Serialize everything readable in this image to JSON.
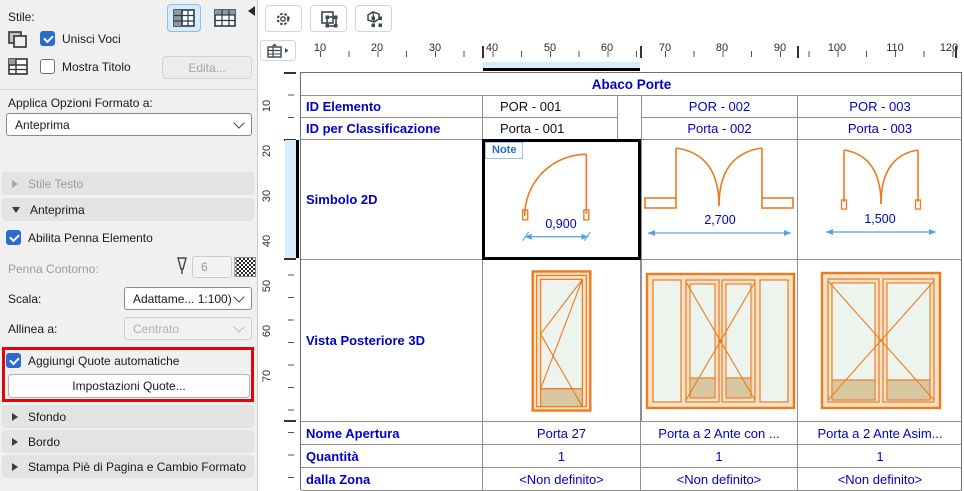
{
  "sidebar": {
    "stile_label": "Stile:",
    "unisci_voci": "Unisci Voci",
    "mostra_titolo": "Mostra Titolo",
    "edita_button": "Edita...",
    "applica_label": "Applica Opzioni Formato a:",
    "applica_value": "Anteprima",
    "stile_testo_section": "Stile Testo",
    "anteprima_section": "Anteprima",
    "abilita_penna": "Abilita Penna Elemento",
    "penna_contorno_label": "Penna Contorno:",
    "penna_value": "6",
    "scala_label": "Scala:",
    "scala_value": "Adattame... 1:100)",
    "allinea_label": "Allinea a:",
    "allinea_value": "Centrato",
    "aggiungi_quote": "Aggiungi Quote automatiche",
    "impostazioni_quote_button": "Impostazioni Quote...",
    "sfondo_section": "Sfondo",
    "bordo_section": "Bordo",
    "stampa_section": "Stampa Piè di Pagina e Cambio Formato"
  },
  "ruler": {
    "h": [
      "10",
      "20",
      "30",
      "40",
      "50",
      "60",
      "70",
      "80",
      "90",
      "100",
      "110",
      "120"
    ],
    "v": [
      "10",
      "20",
      "30",
      "40",
      "50",
      "60",
      "70"
    ]
  },
  "table": {
    "title": "Abaco Porte",
    "note_chip": "Note",
    "rows": {
      "id_elemento": {
        "label": "ID Elemento",
        "values": [
          "POR - 001",
          "POR - 002",
          "POR - 003"
        ]
      },
      "id_classificazione": {
        "label": "ID per Classificazione",
        "values": [
          "Porta - 001",
          "Porta - 002",
          "Porta - 003"
        ]
      },
      "simbolo_2d": {
        "label": "Simbolo 2D",
        "dimensions": [
          "0,900",
          "2,700",
          "1,500"
        ]
      },
      "vista_posteriore_3d": {
        "label": "Vista Posteriore 3D"
      },
      "nome_apertura": {
        "label": "Nome Apertura",
        "values": [
          "Porta 27",
          "Porta a 2 Ante con ...",
          "Porta a 2 Ante Asim..."
        ]
      },
      "quantita": {
        "label": "Quantità",
        "values": [
          "1",
          "1",
          "1"
        ]
      },
      "dalla_zona": {
        "label": "dalla Zona",
        "values": [
          "<Non definito>",
          "<Non definito>",
          "<Non definito>"
        ]
      }
    }
  },
  "colors": {
    "accent_blue": "#0000cd",
    "drawing_orange": "#ee7a1e",
    "dimension_blue": "#4da3e8",
    "highlight_red": "#dd0707",
    "selection_highlight": "#d8ecf9",
    "checkbox_blue": "#2a6bd2"
  },
  "icons": {
    "gear": "settings-menu",
    "select_2d": "marquee-2d",
    "select_3d": "marquee-3d",
    "pen": "pen-nib",
    "merge_cells": "merge-cells",
    "header_row": "table-header"
  }
}
